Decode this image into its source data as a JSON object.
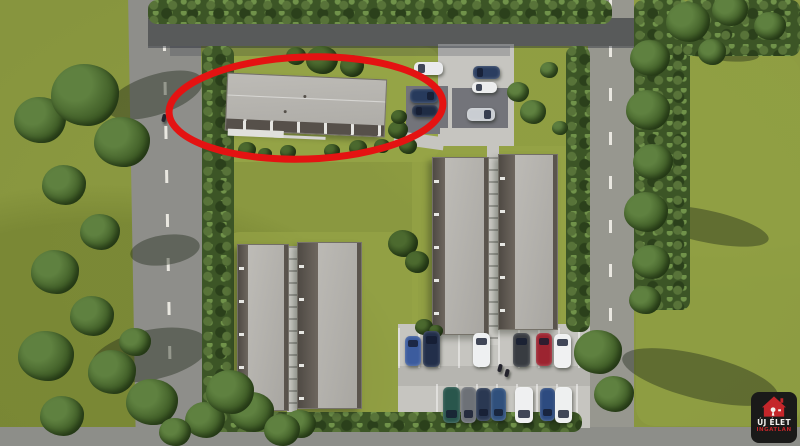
{
  "logo": {
    "line1": "ÚJ ÉLET",
    "line2": "INGATLAN",
    "bg": "#1a1a19",
    "house": "#c4262a",
    "text1": "#f3f2ee",
    "text2": "#c4262a"
  },
  "annotation": {
    "type": "ellipse",
    "color": "#e41312",
    "label": "highlighted-building",
    "cx": 306,
    "cy": 108,
    "rx": 137,
    "ry": 51,
    "stroke_width": 7
  },
  "scene": {
    "description": "Aerial 3D architectural rendering of a residential development: four row-house blocks, a fifth long building circled in red, perimeter roads with dashed markings, two parking areas with cars, hedges and trees, real-estate watermark logo bottom right",
    "palette": {
      "grass": "#87953e",
      "lawn_bright": "#9aa94a",
      "road": "#8e8e8a",
      "road_marking": "#e9e7e0",
      "roof_light": "#b3b1ac",
      "roof_dark": "#5a544d",
      "pavement": "#c6c5c0",
      "hedge": "#3c5526",
      "highlight_red": "#e41312"
    },
    "buildings": [
      {
        "id": "circled",
        "x": 226,
        "y": 76,
        "w": 158,
        "h": 56,
        "rot": 2.5,
        "hl": true
      },
      {
        "id": "row-a",
        "x": 237,
        "y": 244,
        "w": 50,
        "h": 165,
        "strip": 10
      },
      {
        "id": "row-b",
        "x": 297,
        "y": 242,
        "w": 63,
        "h": 165,
        "strip": 20
      },
      {
        "id": "row-c",
        "x": 432,
        "y": 157,
        "w": 55,
        "h": 176,
        "strip": 12
      },
      {
        "id": "row-d",
        "x": 498,
        "y": 154,
        "w": 58,
        "h": 174,
        "strip": 16
      }
    ],
    "cars": [
      {
        "x": 414,
        "y": 62,
        "w": 29,
        "h": 13,
        "c": "#e9eaec",
        "g": "l"
      },
      {
        "x": 410,
        "y": 89,
        "w": 28,
        "h": 14,
        "c": "#273a5c",
        "g": "r"
      },
      {
        "x": 412,
        "y": 105,
        "w": 26,
        "h": 12,
        "c": "#1f2c44",
        "g": "l"
      },
      {
        "x": 473,
        "y": 66,
        "w": 27,
        "h": 13,
        "c": "#2b3e60",
        "g": "l"
      },
      {
        "x": 472,
        "y": 82,
        "w": 25,
        "h": 11,
        "c": "#eceded",
        "g": "l"
      },
      {
        "x": 467,
        "y": 108,
        "w": 28,
        "h": 13,
        "c": "#c9cdd2",
        "g": "r"
      },
      {
        "x": 405,
        "y": 336,
        "w": 16,
        "h": 30,
        "c": "#3c5c9e",
        "g": "t"
      },
      {
        "x": 423,
        "y": 331,
        "w": 17,
        "h": 36,
        "c": "#222f4a",
        "g": "t"
      },
      {
        "x": 473,
        "y": 333,
        "w": 17,
        "h": 34,
        "c": "#eef0f1",
        "g": "t"
      },
      {
        "x": 513,
        "y": 333,
        "w": 17,
        "h": 34,
        "c": "#383c41",
        "g": "t"
      },
      {
        "x": 536,
        "y": 333,
        "w": 16,
        "h": 33,
        "c": "#9c2430",
        "g": "t"
      },
      {
        "x": 554,
        "y": 334,
        "w": 17,
        "h": 34,
        "c": "#f0f1f2",
        "g": "t"
      },
      {
        "x": 443,
        "y": 387,
        "w": 17,
        "h": 36,
        "c": "#29564c",
        "g": "b"
      },
      {
        "x": 461,
        "y": 387,
        "w": 15,
        "h": 36,
        "c": "#6d7177",
        "g": "b"
      },
      {
        "x": 476,
        "y": 388,
        "w": 15,
        "h": 33,
        "c": "#2a3852",
        "g": "b"
      },
      {
        "x": 491,
        "y": 388,
        "w": 15,
        "h": 33,
        "c": "#30507c",
        "g": "b"
      },
      {
        "x": 515,
        "y": 387,
        "w": 18,
        "h": 36,
        "c": "#eff0f1",
        "g": "b"
      },
      {
        "x": 540,
        "y": 388,
        "w": 15,
        "h": 33,
        "c": "#2d4b80",
        "g": "b"
      },
      {
        "x": 555,
        "y": 387,
        "w": 17,
        "h": 36,
        "c": "#eef0f0",
        "g": "b"
      }
    ],
    "people": [
      {
        "x": 162,
        "y": 114
      },
      {
        "x": 498,
        "y": 364
      },
      {
        "x": 505,
        "y": 369
      }
    ],
    "trees": [
      {
        "x": 40,
        "y": 120,
        "r": 26
      },
      {
        "x": 85,
        "y": 95,
        "r": 34
      },
      {
        "x": 122,
        "y": 142,
        "r": 28
      },
      {
        "x": 64,
        "y": 185,
        "r": 22
      },
      {
        "x": 100,
        "y": 232,
        "r": 20
      },
      {
        "x": 55,
        "y": 272,
        "r": 24
      },
      {
        "x": 92,
        "y": 316,
        "r": 22
      },
      {
        "x": 46,
        "y": 356,
        "r": 28
      },
      {
        "x": 112,
        "y": 372,
        "r": 24
      },
      {
        "x": 152,
        "y": 402,
        "r": 26
      },
      {
        "x": 62,
        "y": 416,
        "r": 22
      },
      {
        "x": 205,
        "y": 420,
        "r": 20
      },
      {
        "x": 252,
        "y": 412,
        "r": 22
      },
      {
        "x": 300,
        "y": 424,
        "r": 16
      },
      {
        "x": 175,
        "y": 432,
        "r": 16
      },
      {
        "x": 230,
        "y": 392,
        "r": 24
      },
      {
        "x": 282,
        "y": 430,
        "r": 18
      },
      {
        "x": 135,
        "y": 342,
        "r": 16
      },
      {
        "x": 650,
        "y": 58,
        "r": 20
      },
      {
        "x": 648,
        "y": 110,
        "r": 22
      },
      {
        "x": 653,
        "y": 162,
        "r": 20
      },
      {
        "x": 646,
        "y": 212,
        "r": 22
      },
      {
        "x": 651,
        "y": 262,
        "r": 19
      },
      {
        "x": 645,
        "y": 300,
        "r": 16
      },
      {
        "x": 688,
        "y": 22,
        "r": 22
      },
      {
        "x": 730,
        "y": 10,
        "r": 18
      },
      {
        "x": 770,
        "y": 26,
        "r": 16
      },
      {
        "x": 712,
        "y": 52,
        "r": 14
      },
      {
        "x": 598,
        "y": 352,
        "r": 24
      },
      {
        "x": 614,
        "y": 394,
        "r": 20
      },
      {
        "x": 322,
        "y": 60,
        "r": 16,
        "d": 1
      },
      {
        "x": 352,
        "y": 66,
        "r": 12,
        "d": 1
      },
      {
        "x": 296,
        "y": 56,
        "r": 10,
        "d": 1
      },
      {
        "x": 398,
        "y": 130,
        "r": 10,
        "d": 1
      },
      {
        "x": 408,
        "y": 146,
        "r": 9,
        "d": 1
      },
      {
        "x": 399,
        "y": 117,
        "r": 8,
        "d": 1
      },
      {
        "x": 518,
        "y": 92,
        "r": 11
      },
      {
        "x": 533,
        "y": 112,
        "r": 13
      },
      {
        "x": 549,
        "y": 70,
        "r": 9
      },
      {
        "x": 560,
        "y": 128,
        "r": 8
      },
      {
        "x": 403,
        "y": 243,
        "r": 15,
        "d": 1
      },
      {
        "x": 417,
        "y": 262,
        "r": 12,
        "d": 1
      },
      {
        "x": 247,
        "y": 150,
        "r": 9,
        "d": 1
      },
      {
        "x": 265,
        "y": 154,
        "r": 7,
        "d": 1
      },
      {
        "x": 288,
        "y": 152,
        "r": 8,
        "d": 1
      },
      {
        "x": 332,
        "y": 151,
        "r": 8,
        "d": 1
      },
      {
        "x": 358,
        "y": 148,
        "r": 9,
        "d": 1
      },
      {
        "x": 382,
        "y": 146,
        "r": 8,
        "d": 1
      },
      {
        "x": 424,
        "y": 327,
        "r": 9,
        "d": 1
      },
      {
        "x": 436,
        "y": 331,
        "r": 7,
        "d": 1
      }
    ]
  }
}
